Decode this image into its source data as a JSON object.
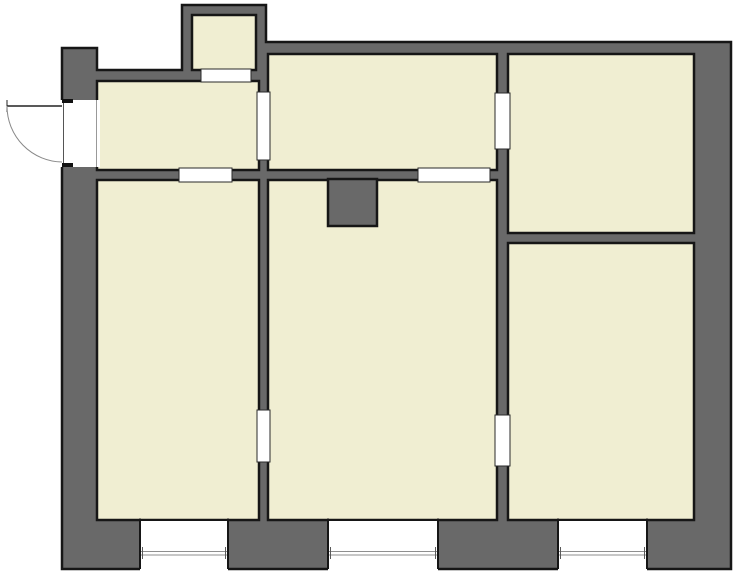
{
  "plan": {
    "canvas": {
      "width": 736,
      "height": 572,
      "background": "#ffffff"
    },
    "colors": {
      "wall_fill": "#696969",
      "wall_outline": "#161616",
      "floor_fill": "#f0eed2",
      "opening_fill": "#ffffff",
      "opening_frame": "#2a2a2a",
      "glazing_line": "#8f8f8f",
      "glazing_tick": "#5a5a5a",
      "door_leaf": "#222222",
      "door_arc": "#888888",
      "jamb_black": "#111111",
      "edge_line_dark": "#555555",
      "edge_line_light": "#999999"
    },
    "outer_boundary": [
      [
        182,
        5
      ],
      [
        266,
        5
      ],
      [
        266,
        42
      ],
      [
        731,
        42
      ],
      [
        731,
        569
      ],
      [
        62,
        569
      ],
      [
        62,
        48
      ],
      [
        97,
        48
      ],
      [
        97,
        70
      ],
      [
        182,
        70
      ]
    ],
    "rooms": [
      {
        "name": "top-small-room",
        "rect": [
          192,
          15,
          64,
          55
        ]
      },
      {
        "name": "entry-hall",
        "rect": [
          97,
          81,
          162,
          89
        ]
      },
      {
        "name": "top-middle-room",
        "rect": [
          268,
          54,
          229,
          116
        ]
      },
      {
        "name": "top-right-room",
        "rect": [
          508,
          54,
          186,
          179
        ]
      },
      {
        "name": "bottom-right-room",
        "rect": [
          508,
          243,
          186,
          277
        ]
      },
      {
        "name": "bottom-middle-room",
        "rect": [
          268,
          180,
          229,
          340
        ]
      },
      {
        "name": "bottom-left-room",
        "rect": [
          97,
          180,
          162,
          340
        ]
      }
    ],
    "chimney": {
      "rect": [
        328,
        179,
        49,
        47
      ]
    },
    "door_openings": [
      {
        "name": "opening-top-small-to-entry",
        "rect": [
          201,
          69,
          50,
          13
        ]
      },
      {
        "name": "door-entry-to-bottom-left",
        "rect": [
          179,
          168,
          53,
          14
        ]
      },
      {
        "name": "door-entry-to-top-middle",
        "rect": [
          257,
          92,
          13,
          68
        ]
      },
      {
        "name": "door-top-middle-to-top-right",
        "rect": [
          495,
          93,
          15,
          56
        ]
      },
      {
        "name": "door-top-middle-to-bottom-middle",
        "rect": [
          418,
          168,
          72,
          14
        ]
      },
      {
        "name": "door-bottom-middle-to-bottom-right",
        "rect": [
          495,
          415,
          15,
          51
        ]
      },
      {
        "name": "door-bottom-left-to-bottom-middle",
        "rect": [
          257,
          410,
          13,
          52
        ]
      }
    ],
    "windows": [
      {
        "name": "window-bottom-left",
        "rect": [
          140,
          521,
          88,
          50
        ],
        "glazing_y": [
          551.5,
          555
        ]
      },
      {
        "name": "window-bottom-middle",
        "rect": [
          328,
          521,
          110,
          50
        ],
        "glazing_y": [
          551.5,
          555
        ]
      },
      {
        "name": "window-bottom-right",
        "rect": [
          558,
          521,
          89,
          50
        ],
        "glazing_y": [
          551.5,
          555
        ]
      }
    ],
    "entry_door": {
      "gap_rect": [
        60,
        100,
        40,
        67
      ],
      "closed_line_x": 63.5,
      "inner_line_x": 96.5,
      "jambs": [
        [
          62,
          99,
          11,
          4
        ],
        [
          62,
          163,
          11,
          4
        ]
      ],
      "leaf": {
        "from": [
          7,
          106
        ],
        "to": [
          62,
          106
        ]
      },
      "leaf_tick": {
        "from": [
          7,
          100
        ],
        "to": [
          7,
          112
        ]
      },
      "swing_arc": {
        "start": [
          7,
          106
        ],
        "end": [
          62,
          162
        ],
        "radius": 56
      }
    }
  }
}
